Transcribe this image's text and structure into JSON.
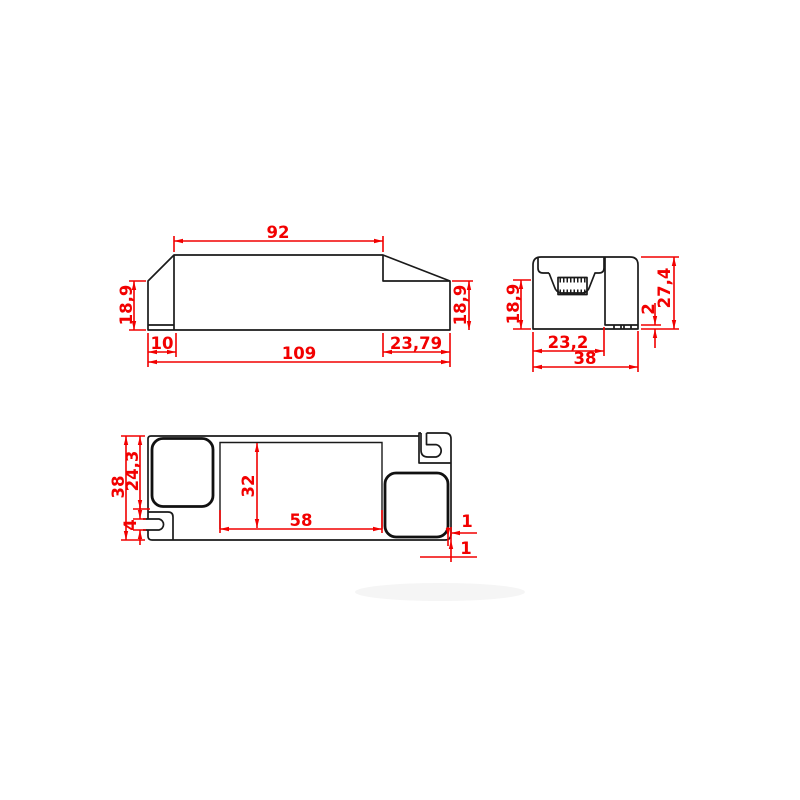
{
  "drawing": {
    "type": "technical-dimension-drawing",
    "views": {
      "side": {
        "dims": {
          "top_width": "92",
          "overall_length": "109",
          "left_height": "18,9",
          "right_height": "18,9",
          "left_tab": "10",
          "right_step": "23,79"
        }
      },
      "end": {
        "dims": {
          "face_height": "18,9",
          "recess_width": "23,2",
          "overall_width": "38",
          "foot_height": "2",
          "overall_height": "27,4"
        }
      },
      "plan": {
        "dims": {
          "overall_width": "38",
          "cover_length": "24,3",
          "slot_width": "4",
          "window_height": "32",
          "window_width": "58",
          "edge_gap_right": "1",
          "edge_gap_bottom": "1"
        }
      }
    },
    "colors": {
      "dimension": "#f20000",
      "outline": "#1a1a1a",
      "background": "#ffffff"
    }
  }
}
